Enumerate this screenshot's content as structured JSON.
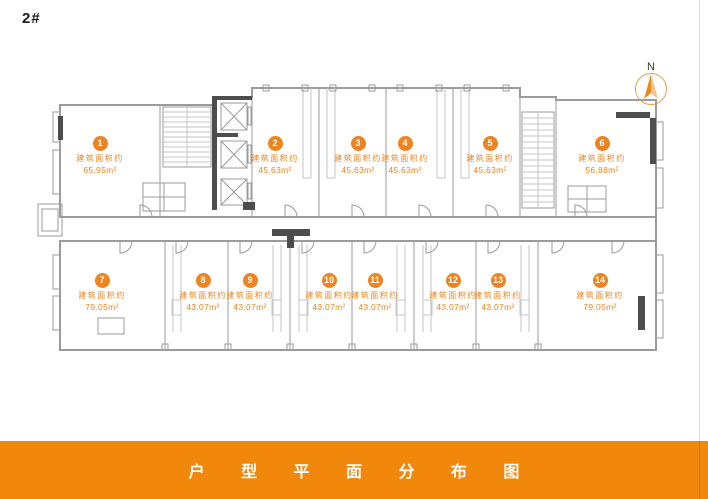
{
  "header": {
    "block_label": "2#"
  },
  "compass": {
    "label": "N"
  },
  "units": [
    {
      "id": "1",
      "area_label": "建筑面积约",
      "area": "65.95m²"
    },
    {
      "id": "2",
      "area_label": "建筑面积约",
      "area": "45.63m²"
    },
    {
      "id": "3",
      "area_label": "建筑面积约",
      "area": "45.63m²"
    },
    {
      "id": "4",
      "area_label": "建筑面积约",
      "area": "45.63m²"
    },
    {
      "id": "5",
      "area_label": "建筑面积约",
      "area": "45.63m²"
    },
    {
      "id": "6",
      "area_label": "建筑面积约",
      "area": "56.88m²"
    },
    {
      "id": "7",
      "area_label": "建筑面积约",
      "area": "79.05m²"
    },
    {
      "id": "8",
      "area_label": "建筑面积约",
      "area": "43.07m²"
    },
    {
      "id": "9",
      "area_label": "建筑面积约",
      "area": "43.07m²"
    },
    {
      "id": "10",
      "area_label": "建筑面积约",
      "area": "43.07m²"
    },
    {
      "id": "11",
      "area_label": "建筑面积约",
      "area": "43.07m²"
    },
    {
      "id": "12",
      "area_label": "建筑面积约",
      "area": "43.07m²"
    },
    {
      "id": "13",
      "area_label": "建筑面积约",
      "area": "43.07m²"
    },
    {
      "id": "14",
      "area_label": "建筑面积约",
      "area": "79.05m²"
    }
  ],
  "footer": {
    "title": "户 型 平 面 分 布 图"
  },
  "colors": {
    "accent": "#EE8420",
    "banner": "#F1870B",
    "wall": "#9B9B9B",
    "wall_dark": "#4D4D4D"
  }
}
